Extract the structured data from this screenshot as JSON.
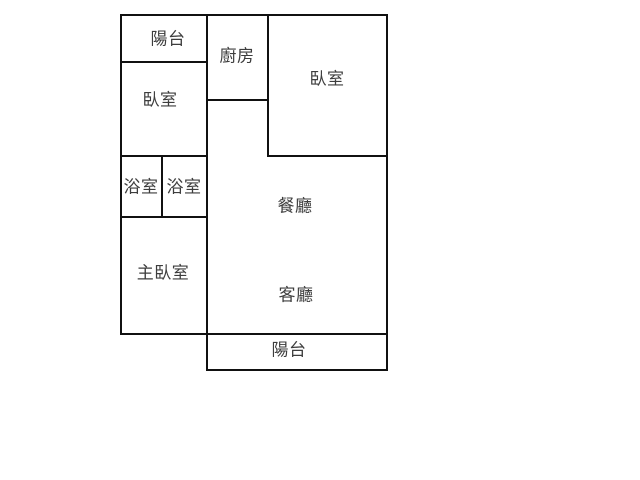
{
  "floor_plan": {
    "type": "apartment-floor-plan",
    "background_color": "#ffffff",
    "wall_color": "#111111",
    "label_color": "#3d3d3d",
    "rooms": [
      {
        "name": "balcony-top",
        "label": "陽台",
        "bounds_px": [
          120,
          14,
          88,
          48
        ]
      },
      {
        "name": "kitchen",
        "label": "廚房",
        "bounds_px": [
          206,
          14,
          63,
          87
        ]
      },
      {
        "name": "bedroom-right",
        "label": "臥室",
        "bounds_px": [
          267,
          14,
          121,
          143
        ]
      },
      {
        "name": "bedroom-left",
        "label": "臥室",
        "bounds_px": [
          120,
          61,
          88,
          96
        ]
      },
      {
        "name": "bathroom-left",
        "label": "浴室",
        "bounds_px": [
          120,
          155,
          43,
          63
        ]
      },
      {
        "name": "bathroom-right",
        "label": "浴室",
        "bounds_px": [
          161,
          155,
          47,
          63
        ]
      },
      {
        "name": "dining-room",
        "label": "餐廳",
        "bounds_px": [
          206,
          100,
          182,
          117
        ]
      },
      {
        "name": "master-bedroom",
        "label": "主臥室",
        "bounds_px": [
          120,
          216,
          88,
          119
        ]
      },
      {
        "name": "living-room",
        "label": "客廳",
        "bounds_px": [
          206,
          217,
          182,
          118
        ]
      },
      {
        "name": "balcony-bottom",
        "label": "陽台",
        "bounds_px": [
          206,
          333,
          182,
          38
        ]
      }
    ]
  }
}
